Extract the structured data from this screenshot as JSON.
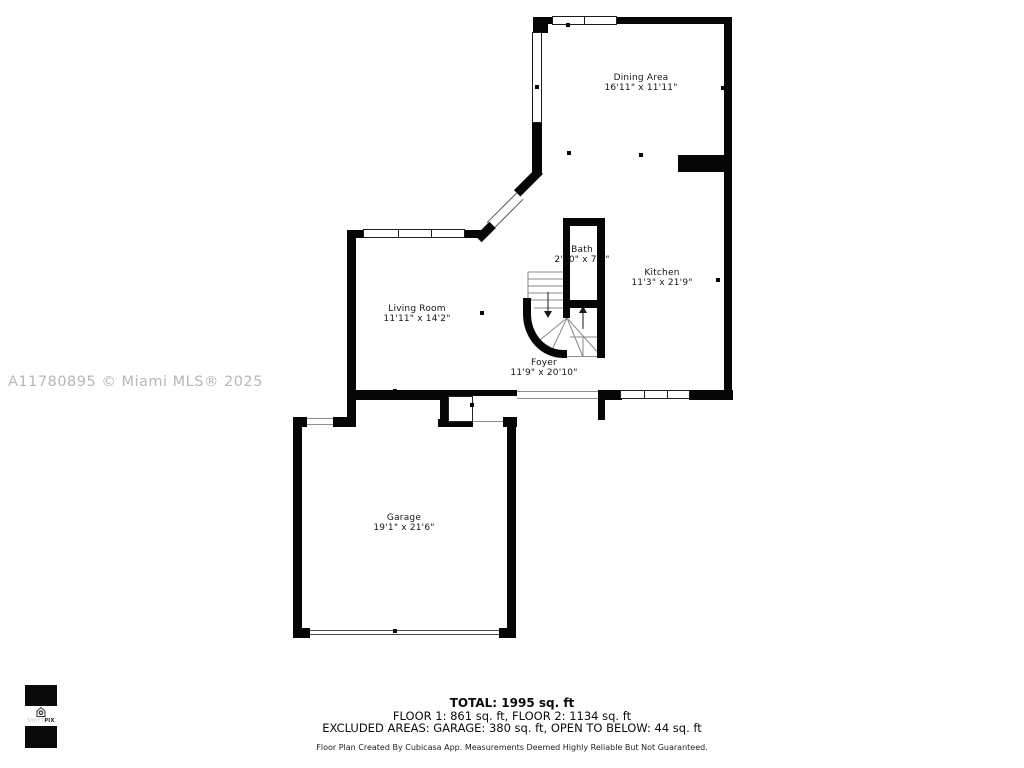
{
  "floorplan": {
    "rooms": {
      "dining": {
        "name": "Dining Area",
        "dims": "16'11\" x 11'11\""
      },
      "kitchen": {
        "name": "Kitchen",
        "dims": "11'3\" x 21'9\""
      },
      "bath": {
        "name": "Bath",
        "dims": "2'10\" x 7'5\""
      },
      "living": {
        "name": "Living Room",
        "dims": "11'11\" x 14'2\""
      },
      "foyer": {
        "name": "Foyer",
        "dims": "11'9\" x 20'10\""
      },
      "garage": {
        "name": "Garage",
        "dims": "19'1\" x 21'6\""
      }
    }
  },
  "watermark": "A11780895 © Miami MLS® 2025",
  "summary": {
    "total": "TOTAL: 1995 sq. ft",
    "floors": "FLOOR 1: 861 sq. ft, FLOOR 2: 1134 sq. ft",
    "excluded": "EXCLUDED AREAS: GARAGE: 380 sq. ft, OPEN TO BELOW: 44 sq. ft",
    "disclaimer": "Floor Plan Created By Cubicasa App. Measurements Deemed Highly Reliable But Not Guaranteed."
  },
  "logo": {
    "brand_light": "SWIFT",
    "brand_bold": "PIX"
  },
  "colors": {
    "wall": "#060606",
    "watermark": "#b7b7b7",
    "background": "#ffffff"
  }
}
